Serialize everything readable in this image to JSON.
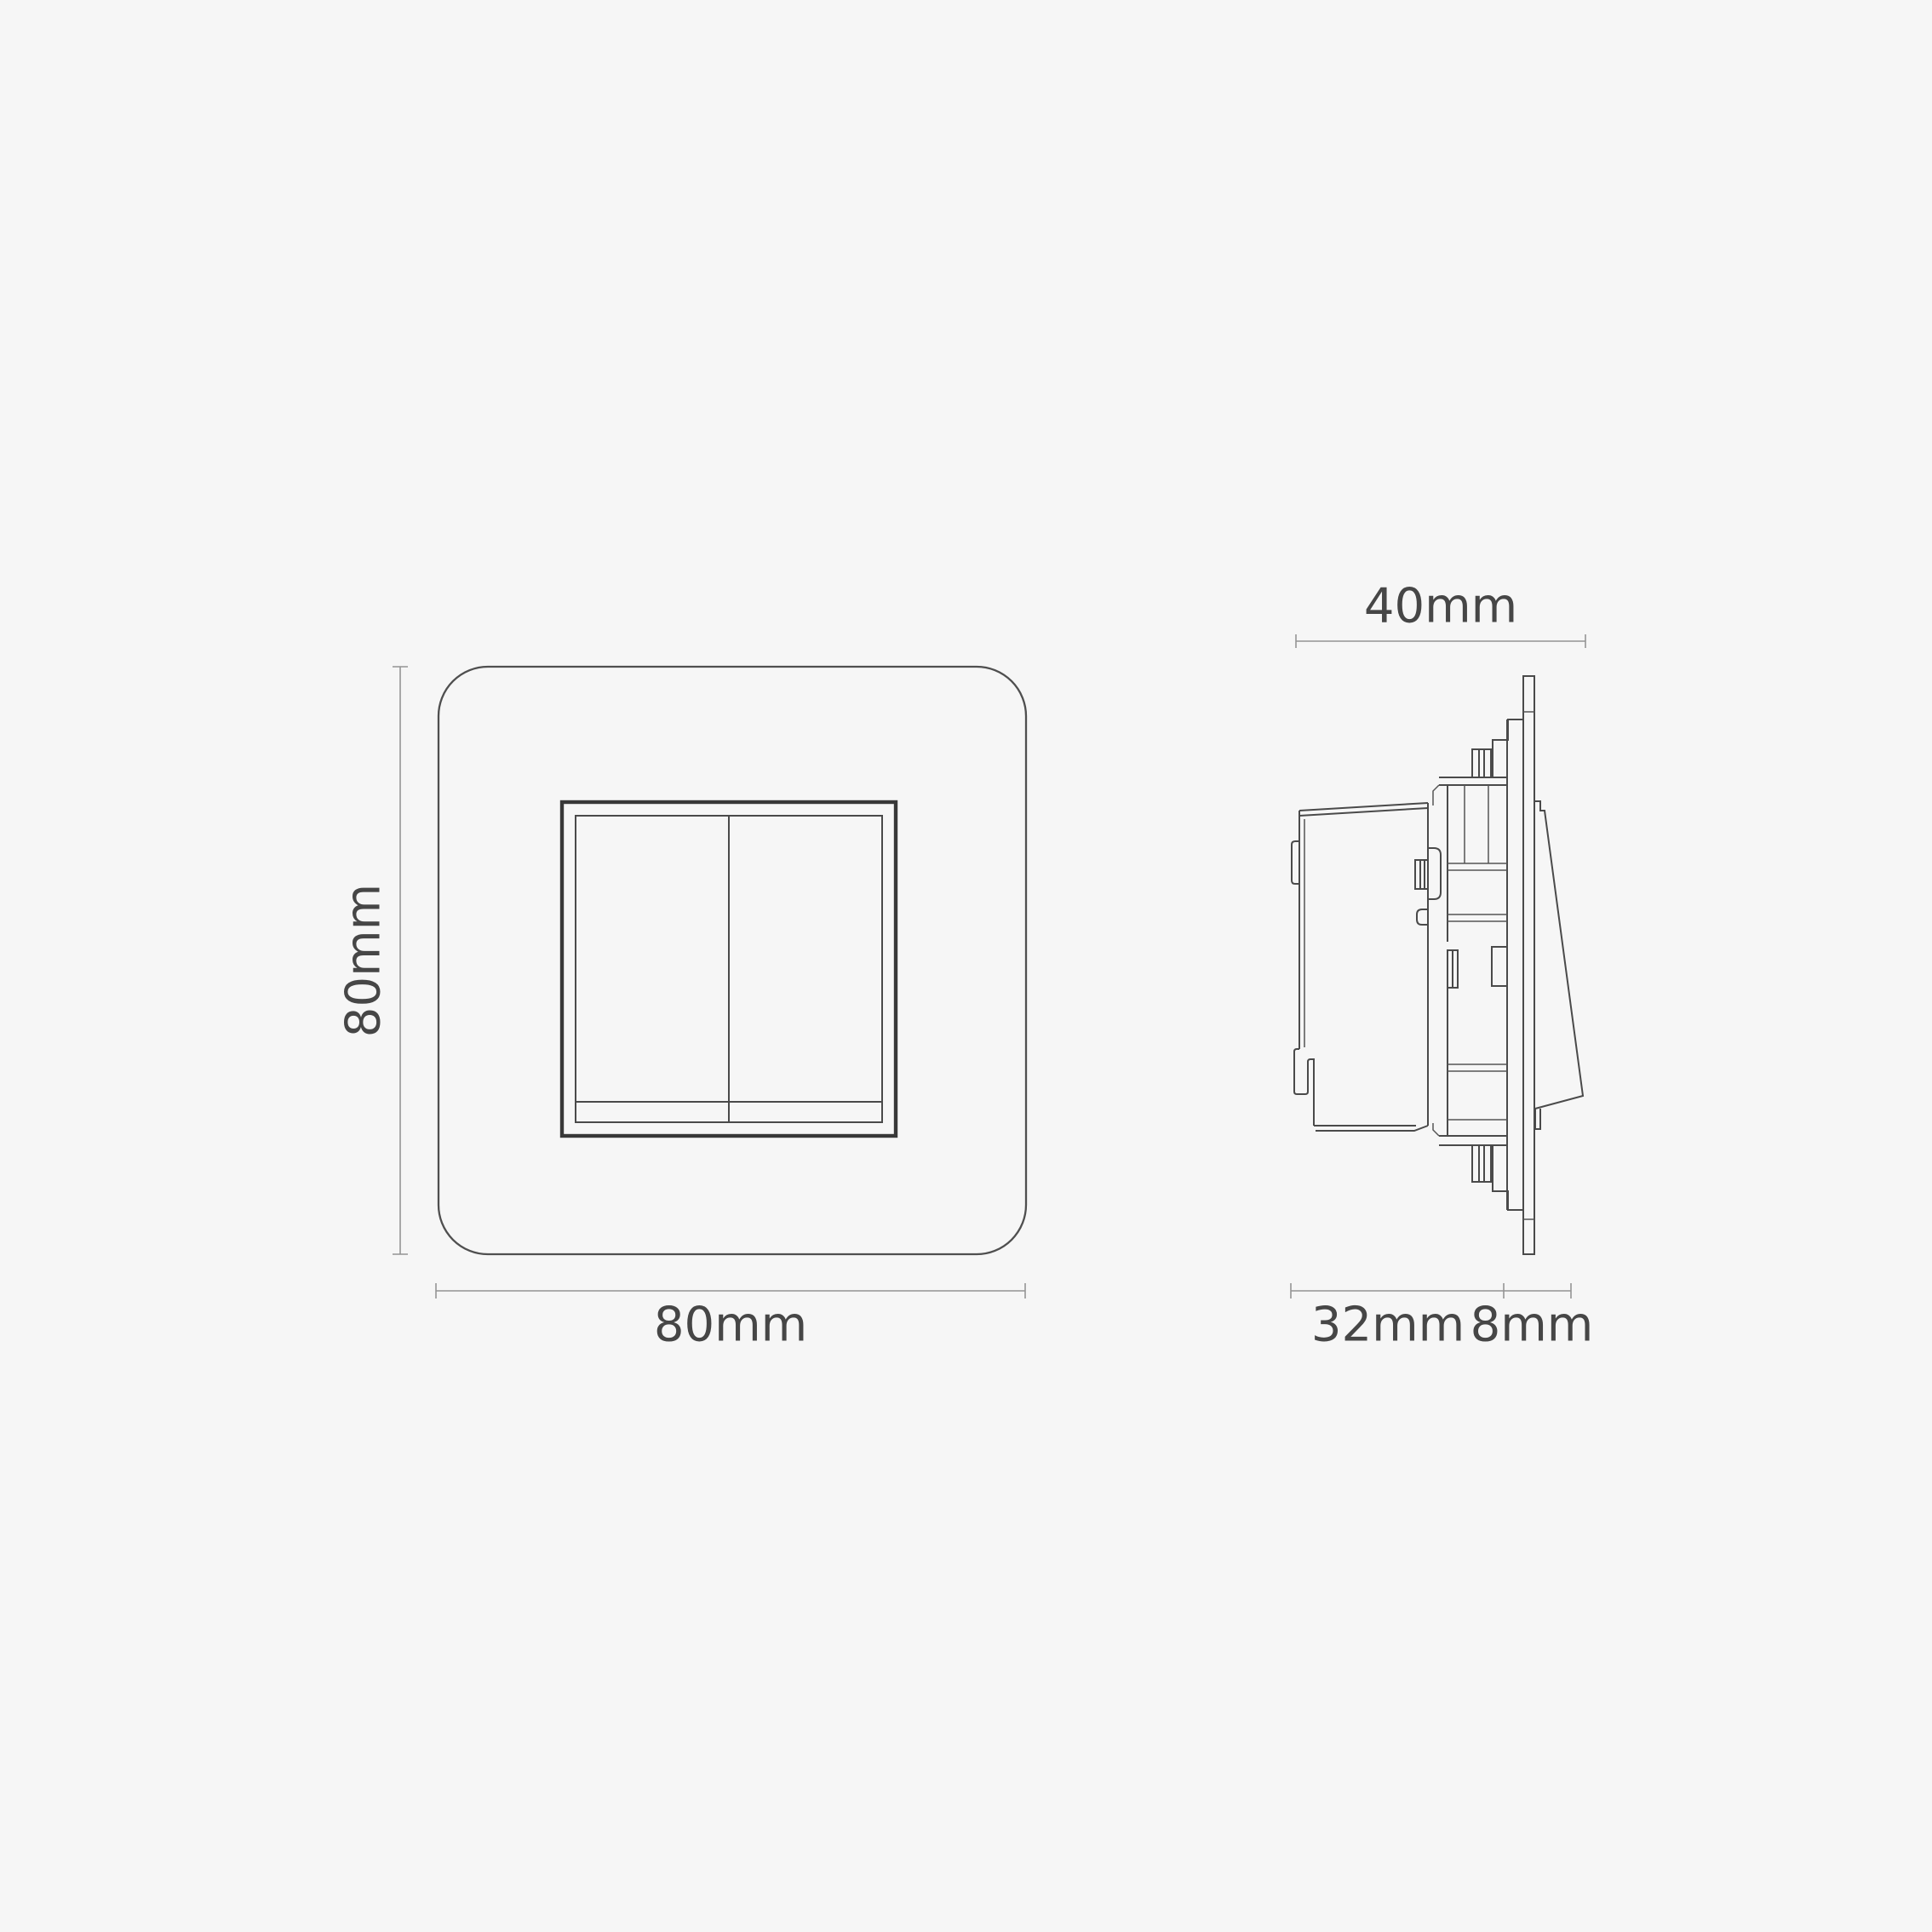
{
  "diagram": {
    "type": "technical-dimension-drawing",
    "subject": "Two-gang rocker switch - front and side elevations with dimensions",
    "front_view": {
      "height_label": "80mm",
      "width_label": "80mm",
      "rocker_count": 2
    },
    "side_view": {
      "overall_depth_label": "40mm",
      "mechanism_depth_label": "32mm",
      "faceplate_depth_label": "8mm"
    },
    "colors": {
      "background": "#f6f6f6",
      "outline": "#4a4a4a",
      "outline_dark": "#383838",
      "dimension_line": "#949494",
      "label_text": "#464646"
    }
  }
}
